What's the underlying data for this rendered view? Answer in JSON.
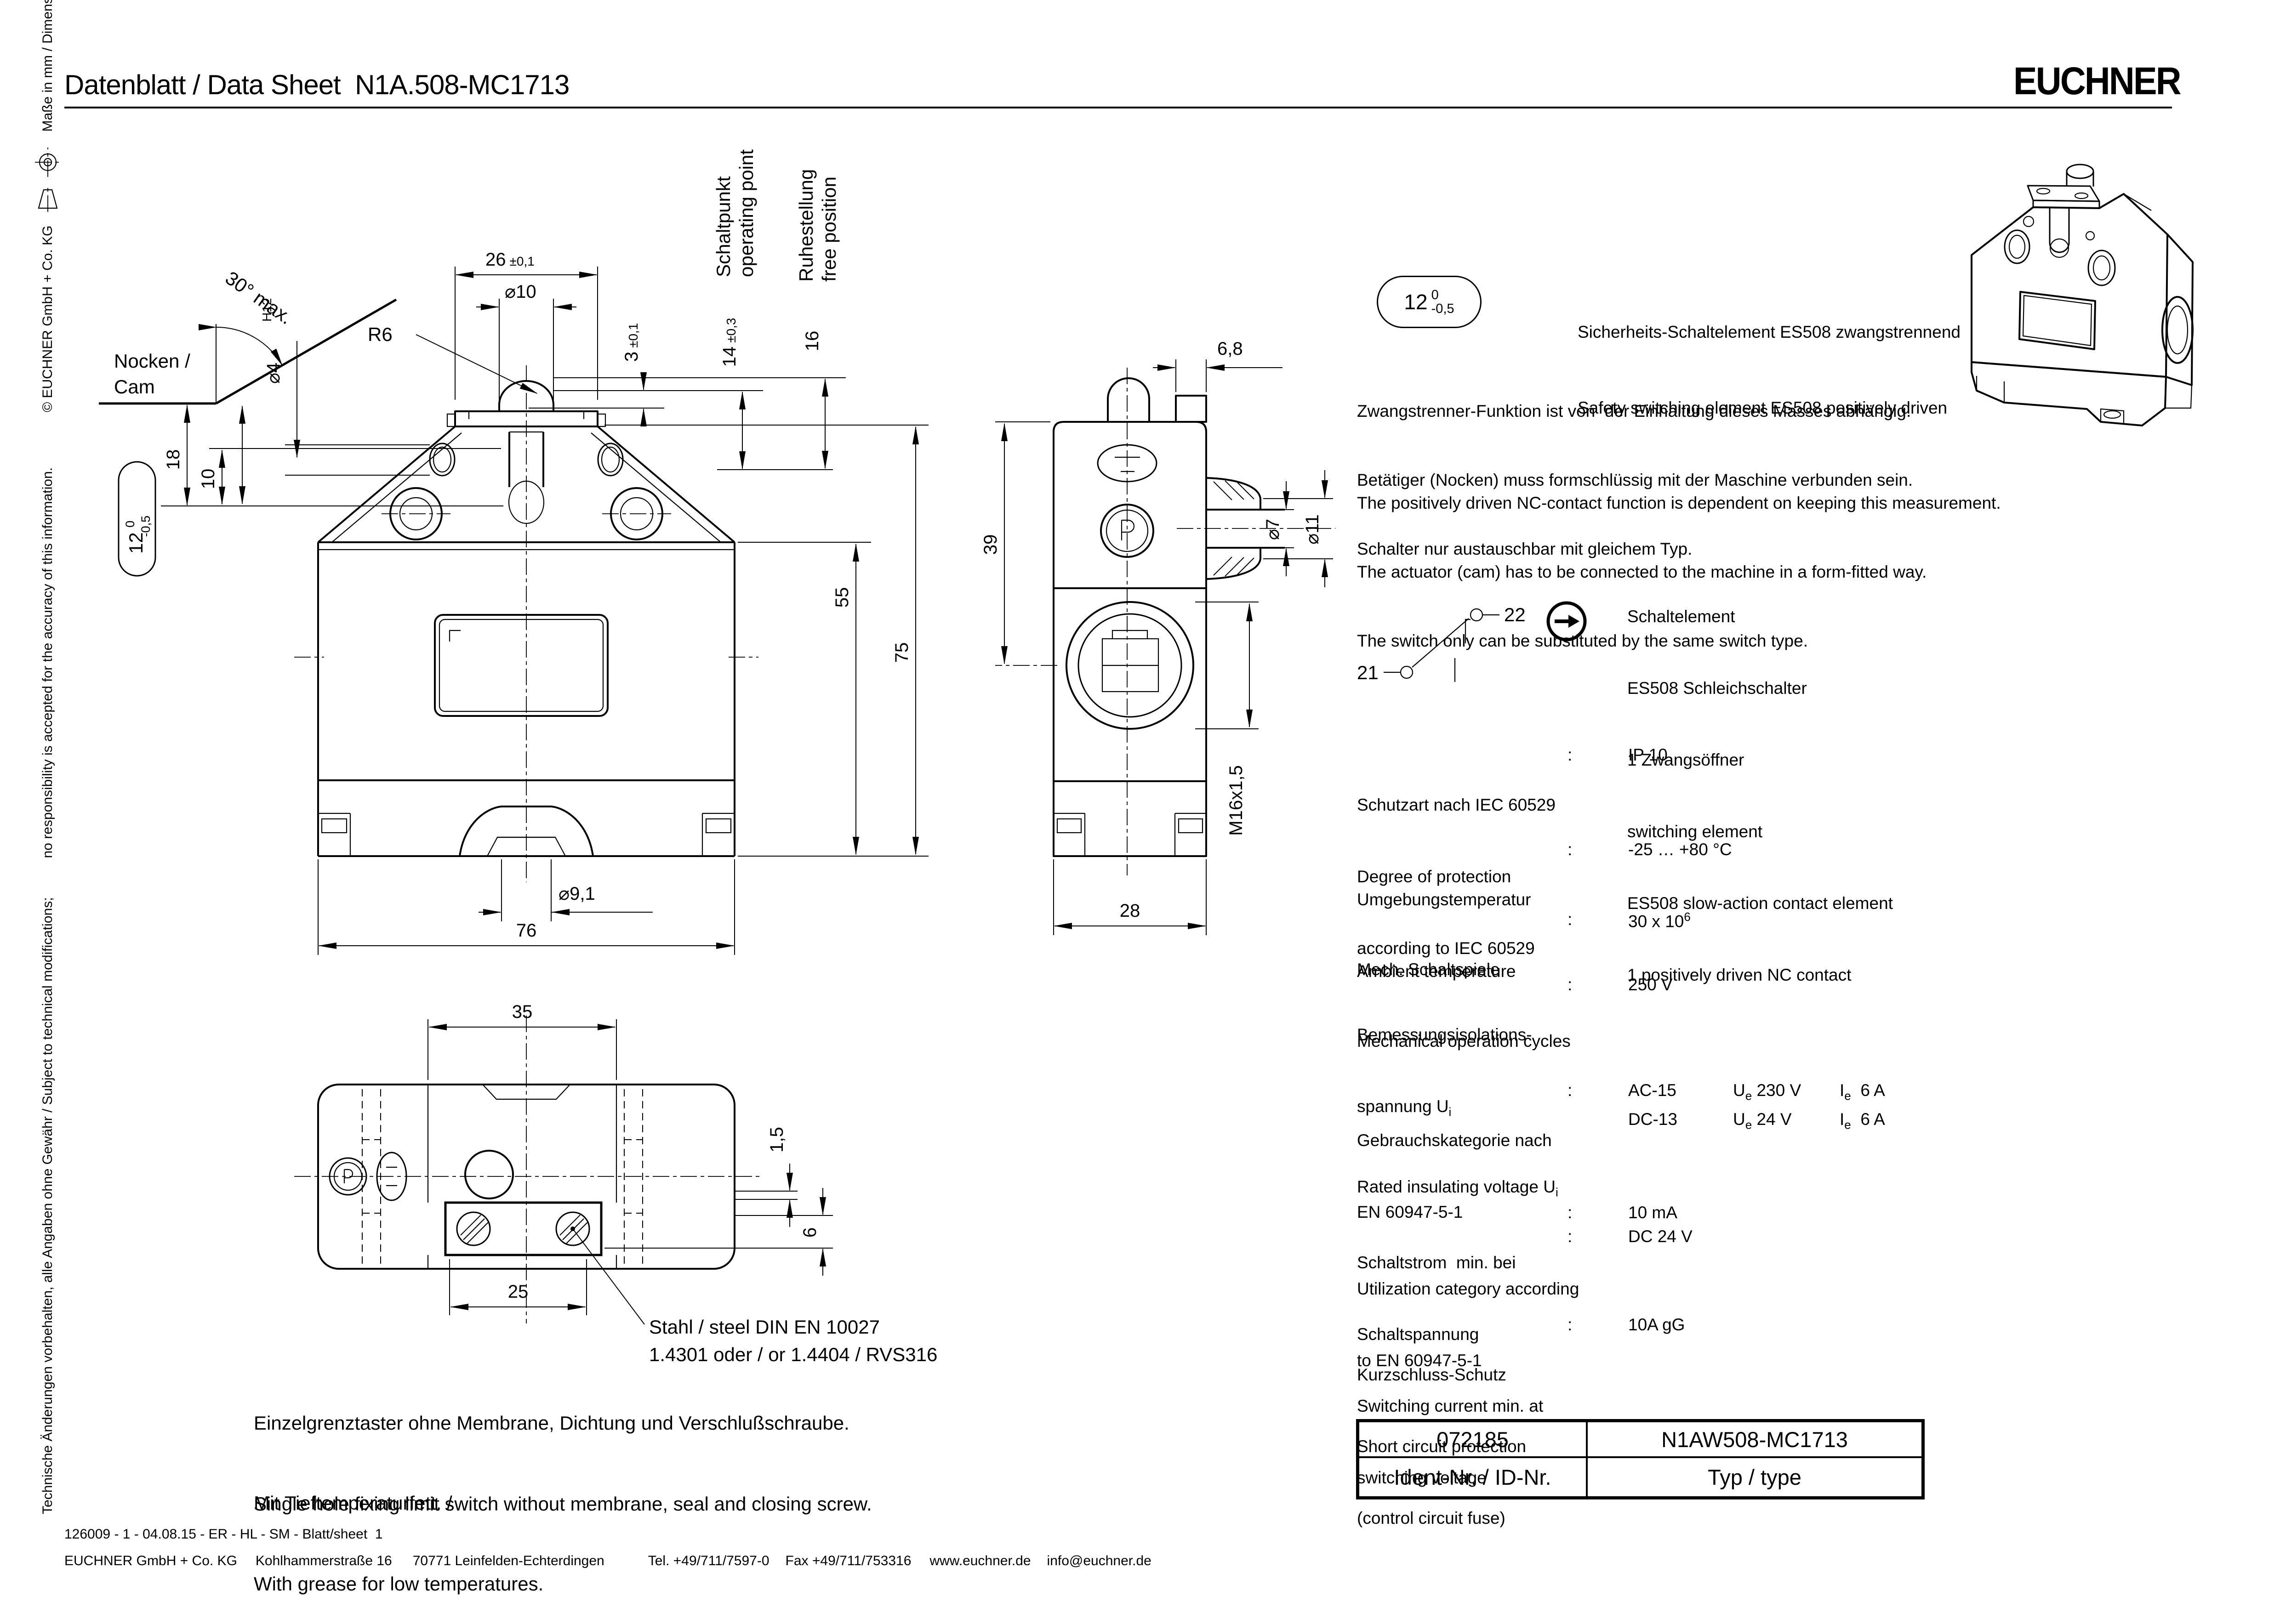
{
  "header": {
    "title": "Datenblatt / Data Sheet  N1A.508-MC1713",
    "logo": "EUCHNER"
  },
  "sidebar": {
    "seg1": "Technische Änderungen vorbehalten, alle Angaben ohne Gewähr / Subject to technical modifications;",
    "seg2": "no responsibility is accepted for the accuracy of this information.",
    "seg3": "© EUCHNER GmbH + Co. KG",
    "seg4": "Maße in mm / Dimensions in mm"
  },
  "icons": {
    "projection_circle": "first-angle-projection-circle-icon",
    "projection_cone": "first-angle-projection-cone-icon",
    "contact_arrow": "actuation-arrow-icon"
  },
  "tol12": {
    "value": "12",
    "top": "0",
    "bottom": "-0,5"
  },
  "cam": {
    "angle": "30° max.",
    "label1": "Nocken /",
    "label2": "Cam",
    "d4": "⌀4",
    "d4tol": "H12",
    "dim_18": "18",
    "dim_10": "10"
  },
  "front_view": {
    "dim26_main": "26",
    "dim26_tol": "±0,1",
    "dim_d10": "⌀10",
    "r6": "R6",
    "dim3_main": "3",
    "dim3_tol": "±0,1",
    "dim14_main": "14",
    "dim14_tol": "±0,3",
    "dim_16": "16",
    "op1": "Schaltpunkt",
    "op2": "operating point",
    "free1": "Ruhestellung",
    "free2": "free position",
    "dim_55": "55",
    "dim_75": "75",
    "dim_d91": "⌀9,1",
    "dim_76": "76"
  },
  "side_view": {
    "dim_68": "6,8",
    "dim_39": "39",
    "dim_d7": "⌀7",
    "dim_d11": "⌀11",
    "dim_m16": "M16x1,5",
    "dim_28": "28"
  },
  "bottom_view": {
    "dim_35": "35",
    "dim_15": "1,5",
    "dim_6": "6",
    "dim_25": "25",
    "material_line1": "Stahl / steel DIN EN 10027",
    "material_line2": "1.4301 oder / or 1.4404 / RVS316"
  },
  "description": {
    "de1": "Einzelgrenztaster ohne Membrane, Dichtung und Verschlußschraube.",
    "de2": "Mit Tieftemperaturfett. /",
    "en1": "Single hole fixing limit switch without membrane, seal and closing screw.",
    "en2": "With grease for low temperatures."
  },
  "right": {
    "heading_de": "Sicherheits-Schaltelement ES508 zwangstrennend",
    "heading_en": "Safety switching element ES508 positively driven",
    "note_de": [
      "Zwangstrenner-Funktion ist von  der Einhaltung dieses Masses abhängig.",
      "Betätiger (Nocken) muss formschlüssig mit der Maschine verbunden sein.",
      "Schalter nur austauschbar mit gleichem Typ."
    ],
    "note_en": [
      "The positively driven NC-contact function is dependent on keeping this measurement.",
      "The actuator (cam) has to be connected to the machine in a form-fitted way.",
      "The switch only can be substituted by the same switch type."
    ],
    "contact": {
      "terminal_left": "21",
      "terminal_right": "22",
      "desc": [
        "Schaltelement",
        "ES508 Schleichschalter",
        "1 Zwangsöffner",
        "switching element",
        "ES508 slow-action contact element",
        "1 positively driven NC contact"
      ]
    },
    "specs": {
      "colon": ":",
      "row1": {
        "l1": "Schutzart nach IEC 60529",
        "l2": "Degree of protection",
        "l3": "according to IEC 60529",
        "value": "IP 10"
      },
      "row2": {
        "l1": "Umgebungstemperatur",
        "l2": "Ambient temperature",
        "value": "-25 … +80 °C"
      },
      "row3": {
        "l1": "Mech. Schaltspiele",
        "l2": "Mechanical operation cycles",
        "value_base": "30 x 10",
        "value_sup": "6"
      },
      "row4": {
        "l1": "Bemessungsisolations-",
        "l2_base": "spannung U",
        "l2_sub": "i",
        "l3_base": "Rated insulating voltage U",
        "l3_sub": "i",
        "value": "250 V"
      },
      "row5": {
        "l1": "Gebrauchskategorie nach",
        "l2": "EN 60947-5-1",
        "l3": "Utilization category according",
        "l4": "to EN 60947-5-1",
        "ac": {
          "cat": "AC-15",
          "u_sym": "U",
          "u_sub": "e",
          "u_val": "230 V",
          "i_sym": "I",
          "i_sub": "e",
          "i_val": "6 A"
        },
        "dc": {
          "cat": "DC-13",
          "u_sym": "U",
          "u_sub": "e",
          "u_val": "24 V",
          "i_sym": "I",
          "i_sub": "e",
          "i_val": "6 A"
        }
      },
      "row6": {
        "l1": "Schaltstrom  min. bei",
        "l2": "Schaltspannung",
        "l3": "Switching current min. at",
        "l4": "switching voltage",
        "value1": "10 mA",
        "value2": "DC 24 V"
      },
      "row7": {
        "l1": "Kurzschluss-Schutz",
        "l2": "Short circuit protection",
        "l3": "(control circuit fuse)",
        "value": "10A gG"
      }
    },
    "id_table": {
      "id_value": "072185",
      "type_value": "N1AW508-MC1713",
      "id_label": "Ident-Nr. / ID-Nr.",
      "type_label": "Typ / type"
    }
  },
  "footer": {
    "line1": "126009 - 1 - 04.08.15 - ER - HL - SM - Blatt/sheet  1",
    "company": "EUCHNER GmbH + Co. KG",
    "street": "Kohlhammerstraße 16",
    "city": "70771 Leinfelden-Echterdingen",
    "tel": "Tel. +49/711/7597-0",
    "fax": "Fax +49/711/753316",
    "web": "www.euchner.de",
    "email": "info@euchner.de"
  }
}
